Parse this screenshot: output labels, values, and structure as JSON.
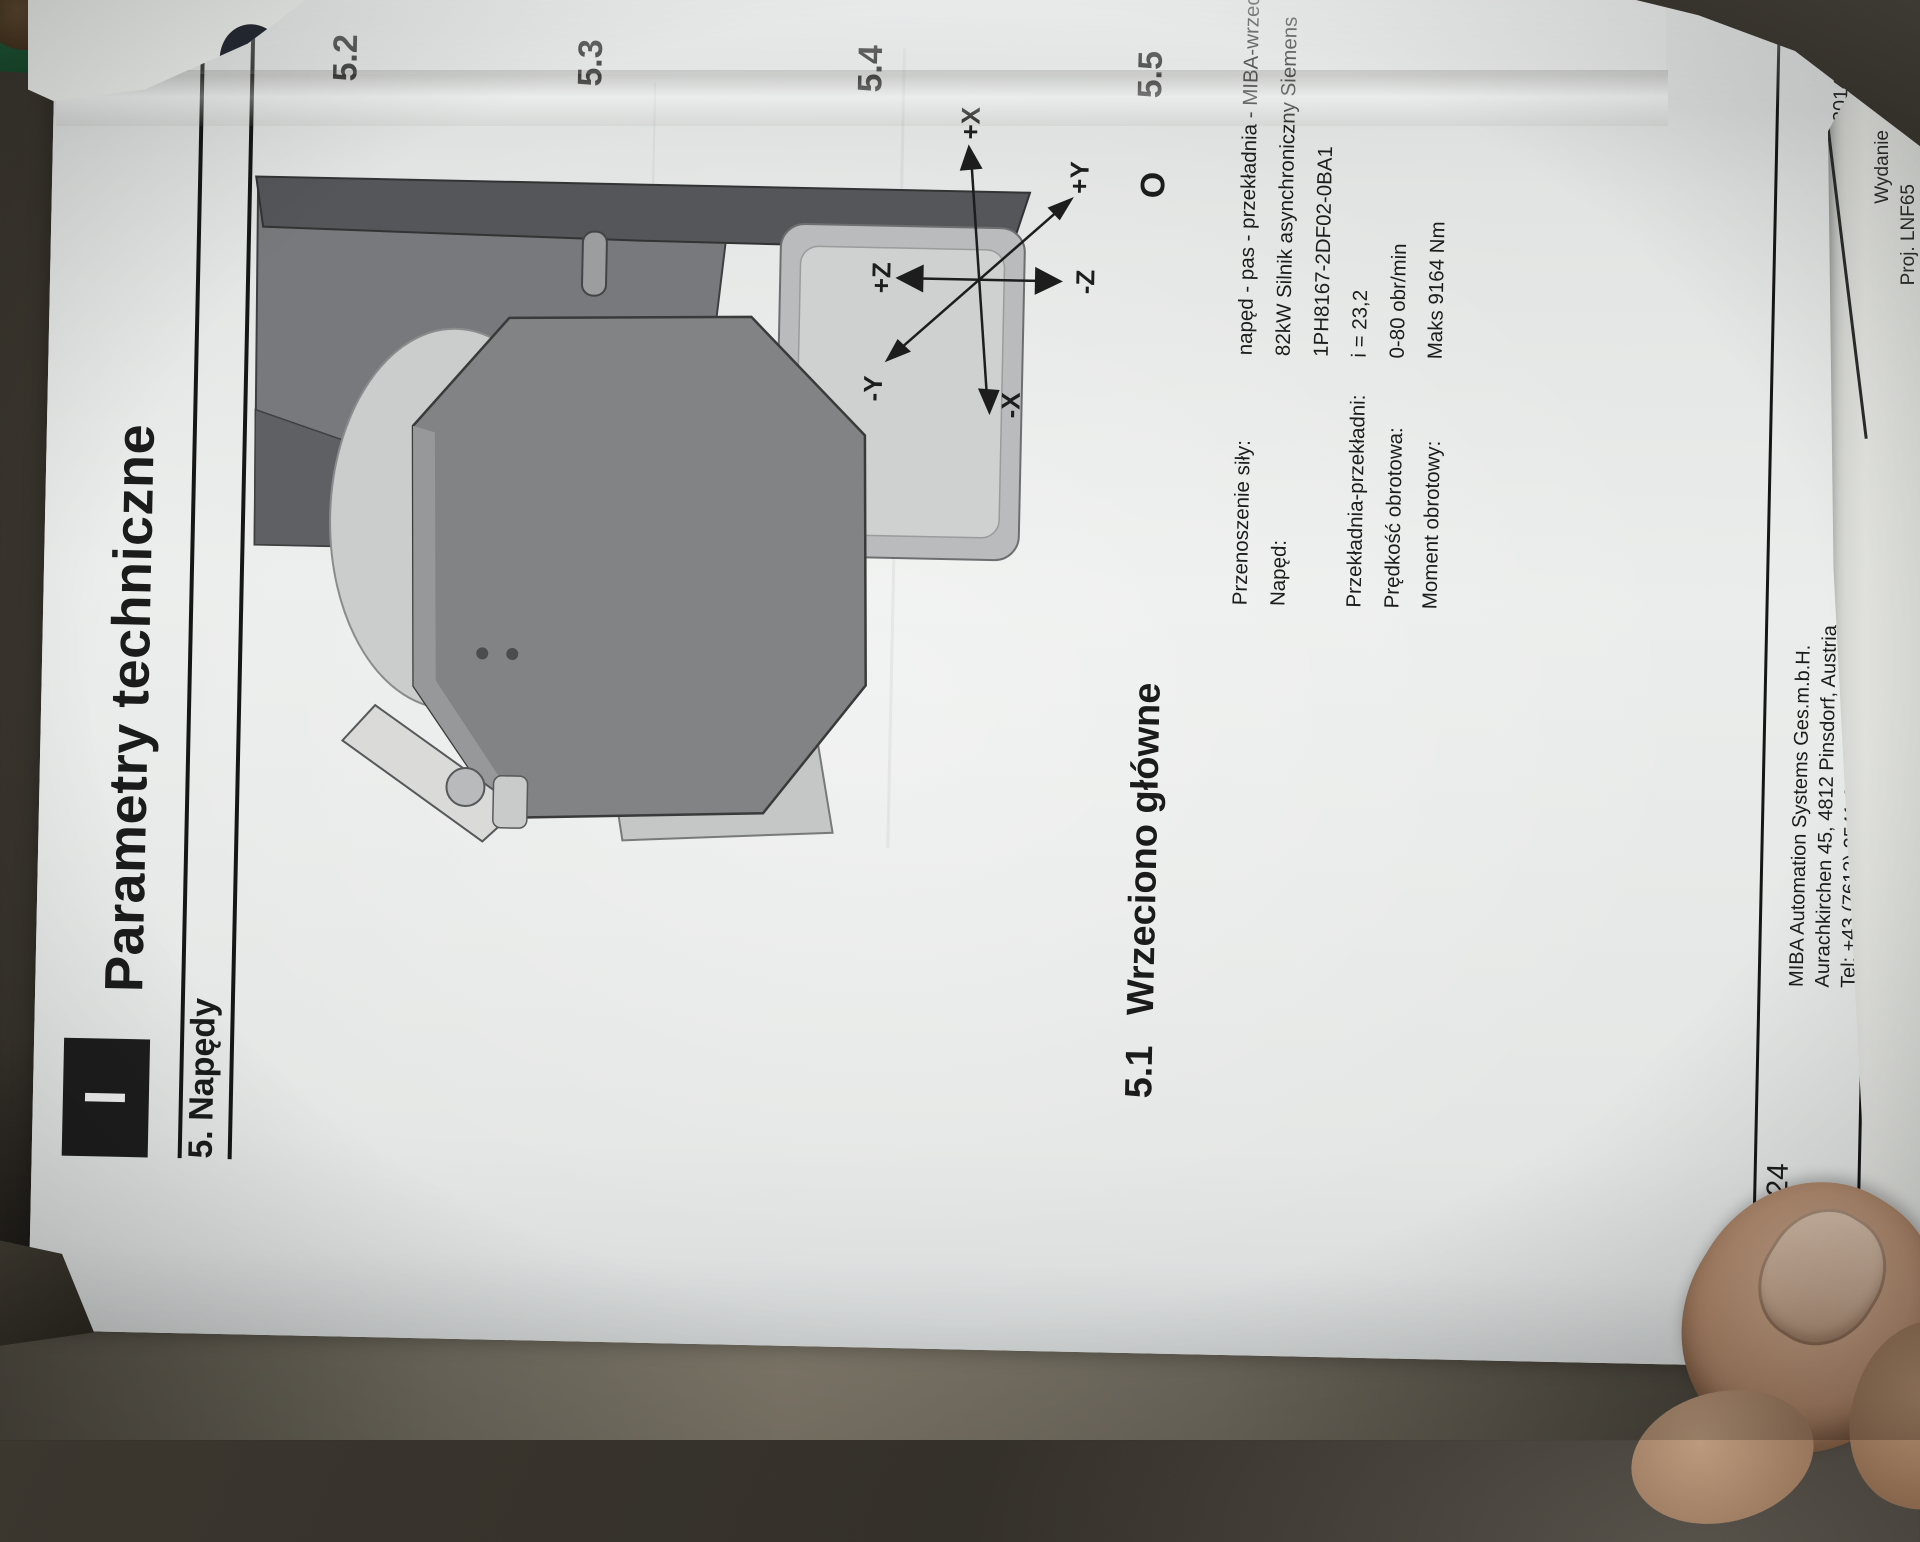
{
  "page": {
    "header": {
      "box_mark": "I",
      "title": "Parametry techniczne",
      "section": "5. Napędy"
    },
    "toc_stubs": {
      "s52": "5.2",
      "s53": "5.3",
      "s54": "5.4",
      "s55": "5.5",
      "fragment": "O"
    },
    "section51": {
      "number": "5.1",
      "title": "Wrzeciono główne"
    },
    "specs": {
      "rows": [
        {
          "label": "Przenoszenie siły:",
          "value": "napęd - pas - przekładnia - MIBA-wrzeciono"
        },
        {
          "label": "Napęd:",
          "value": "82kW Silnik asynchroniczny Siemens",
          "value2": "1PH8167-2DF02-0BA1"
        },
        {
          "label": "Przekładnia-przekładni:",
          "value": "i = 23,2"
        },
        {
          "label": "Prędkość obrotowa:",
          "value": "0-80 obr/min"
        },
        {
          "label": "Moment obrotowy:",
          "value": "Maks 9164 Nm"
        }
      ]
    },
    "axes": {
      "labels": {
        "xp": "+X",
        "xn": "-X",
        "yp": "+Y",
        "yn": "-Y",
        "zp": "+Z",
        "zn": "-Z"
      }
    },
    "footer": {
      "page_number": "24",
      "company_lines": [
        "MIBA Automation Systems Ges.m.b.H.",
        "Aurachkirchen 45, 4812 Pinsdorf, Austria",
        "Tel: +43 (7613) 2541-0, Fax: +43 (7613) 2541-2362"
      ],
      "edition": "Wydanie: 12.2014",
      "doc_number": "NF65-1220-102"
    }
  },
  "underpage": {
    "logo_text": "iba",
    "edition_fragment": "Wydanie",
    "project_fragment": "Proj. LNF65"
  },
  "colors": {
    "paper": "#e6e8e7",
    "ink": "#1b1b1b",
    "table_dark": "#2a2722",
    "table_light": "#7d7668",
    "logo_bg": "#262a33",
    "green_object": "#1d5434",
    "skin": "#ab8468"
  }
}
